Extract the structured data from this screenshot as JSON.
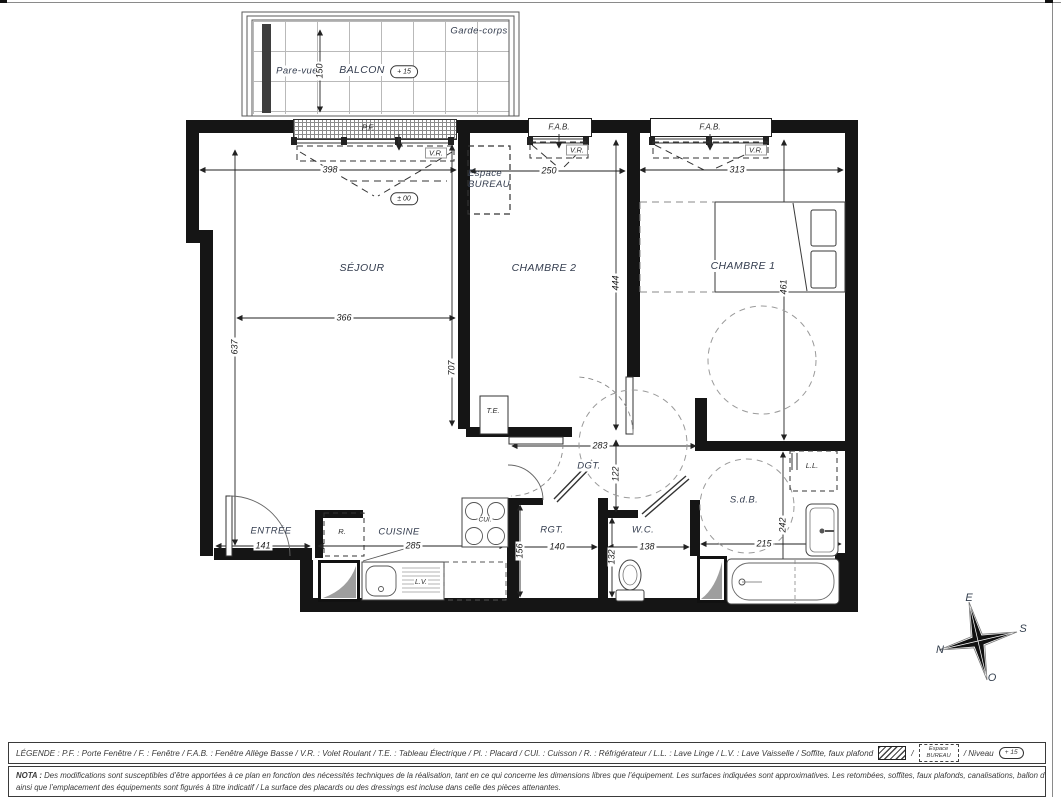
{
  "plan": {
    "balcony": {
      "garde_corps": "Garde-corps",
      "pare_vue": "Pare-vue",
      "name": "BALCON",
      "level": "+ 15",
      "depth": "150"
    },
    "windows": {
      "pf": "P.F.",
      "fab1": "F.A.B.",
      "fab2": "F.A.B.",
      "vr1": "V.R.",
      "vr2": "V.R.",
      "vr3": "V.R."
    },
    "rooms": {
      "sejour": "SÉJOUR",
      "chambre2": "CHAMBRE 2",
      "chambre1": "CHAMBRE 1",
      "entree": "ENTRÉE",
      "cuisine": "CUISINE",
      "rgt": "RGT.",
      "wc": "W.C.",
      "sdb": "S.d.B.",
      "dgt": "DGT.",
      "espace_bureau_1": "Espace",
      "espace_bureau_2": "BUREAU"
    },
    "equipment": {
      "te": "T.E.",
      "fridge": "R.",
      "cooktop": "CUI.",
      "dishwasher": "L.V.",
      "washer": "L.L."
    },
    "level_sejour": "± 00",
    "dims": {
      "balcony_depth": "150",
      "sejour_w": "398",
      "chambre2_w": "250",
      "chambre1_w": "313",
      "sejour_w2": "366",
      "sejour_h": "637",
      "sejour_h2": "707",
      "chambre2_h": "444",
      "chambre1_h": "461",
      "dgt_w": "283",
      "dgt_h": "122",
      "entree_w": "141",
      "cuisine_w": "285",
      "rgt_w": "140",
      "wc_w": "138",
      "sdb_w": "215",
      "rgt_h": "156",
      "wc_h": "132",
      "sdb_h": "242"
    },
    "compass": {
      "e": "E",
      "s": "S",
      "o": "O",
      "n": "N"
    }
  },
  "legend": {
    "text": "LÉGENDE :  P.F. : Porte Fenêtre / F. : Fenêtre / F.A.B. : Fenêtre Allège Basse / V.R. : Volet Roulant / T.E. : Tableau Électrique  / Pl. : Placard  / CUI. : Cuisson / R. : Réfrigérateur / L.L. : Lave Linge /  L.V. : Lave Vaisselle / Soffite, faux plafond",
    "sep": "/",
    "espace_1": "Espace",
    "espace_2": "BUREAU",
    "niveau": "/  Niveau",
    "niveau_value": "+ 15"
  },
  "nota": {
    "label": "NOTA :",
    "line1": "Des modifications sont susceptibles d’être apportées à ce plan en fonction des nécessités techniques de la réalisation, tant en ce qui concerne les dimensions libres que l’équipement. Les surfaces indiquées sont approximatives. Les retombées, soffites, faux plafonds, canalisations, ballon d’eau chaude,",
    "line2": "ainsi que l’emplacement des équipements sont figurés à titre indicatif / La surface des placards ou des dressings est incluse dans celle des pièces attenantes."
  },
  "colors": {
    "wall": "#151515",
    "label": "#333c4e",
    "dim_line": "#222222",
    "grey_shaft": "#9e9e9e"
  }
}
